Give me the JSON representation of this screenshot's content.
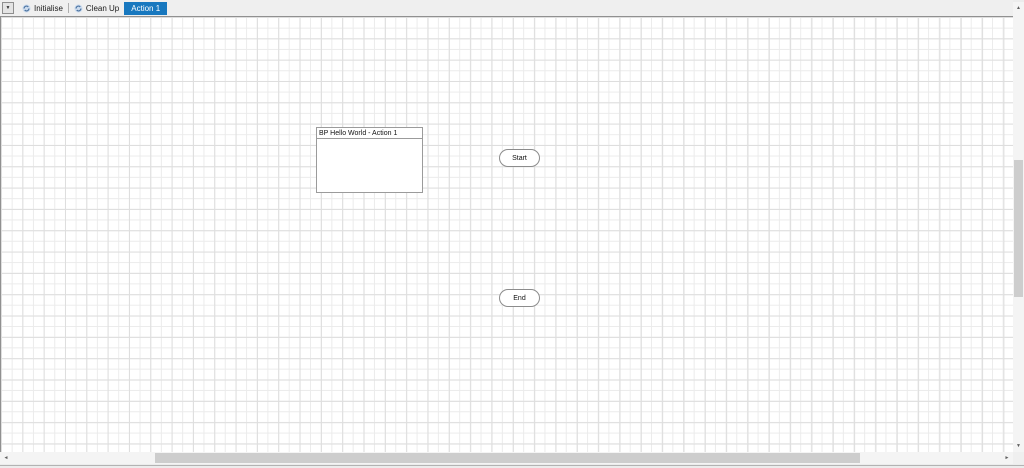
{
  "tabstrip": {
    "dropdown_glyph": "▼",
    "tabs": [
      {
        "label": "Initialise",
        "active": false
      },
      {
        "label": "Clean Up",
        "active": false
      },
      {
        "label": "Action 1",
        "active": true
      }
    ],
    "active_tab": "Action 1"
  },
  "canvas": {
    "note_box": {
      "title": "BP Hello World - Action 1"
    },
    "start_node": {
      "label": "Start"
    },
    "end_node": {
      "label": "End"
    }
  },
  "icons": {
    "page_icon": "page-swirl",
    "scroll_up": "▲",
    "scroll_down": "▼",
    "scroll_left": "◄",
    "scroll_right": "►"
  },
  "colors": {
    "active_tab_bg": "#1878bf",
    "active_tab_text": "#ffffff",
    "tabstrip_bg": "#efefef",
    "canvas_bg": "#ffffff",
    "grid_line_minor": "#ebebeb",
    "grid_line_major": "#dedede",
    "node_border": "#8c8c8c",
    "box_border": "#9b9b9b",
    "scrollbar_track": "#f4f4f4",
    "scrollbar_thumb": "#cdcdcd"
  }
}
